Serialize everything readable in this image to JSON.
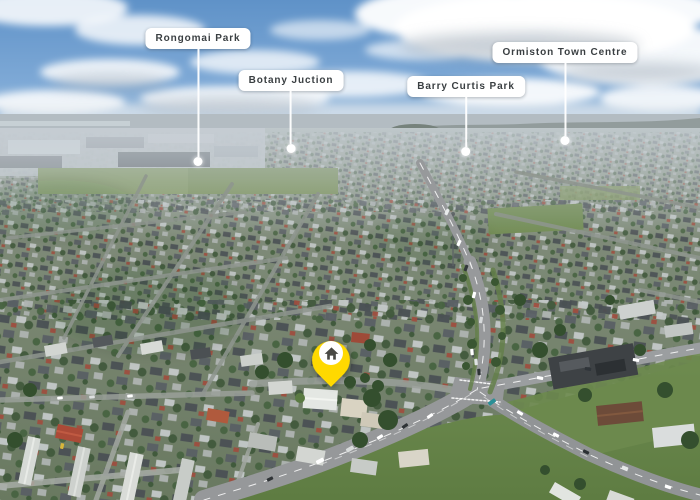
{
  "scene": {
    "type": "aerial-drone-photo",
    "description": "Aerial view over a suburban neighbourhood under a partly cloudy sky, with landmark callouts and a yellow house location pin above a property near a large road intersection",
    "sky_color": "#6f9cce",
    "label_background": "#ffffff",
    "label_text_color": "#3a3f42",
    "leader_line_color": "#ffffff",
    "pin_color": "#ffd900"
  },
  "landmarks": [
    {
      "id": "rongomai-park",
      "label": "Rongomai Park"
    },
    {
      "id": "botany-junction",
      "label": "Botany Juction"
    },
    {
      "id": "barry-curtis-park",
      "label": "Barry Curtis Park"
    },
    {
      "id": "ormiston-town-centre",
      "label": "Ormiston Town Centre"
    }
  ],
  "pin": {
    "icon": "house-icon",
    "color": "#ffd900"
  }
}
